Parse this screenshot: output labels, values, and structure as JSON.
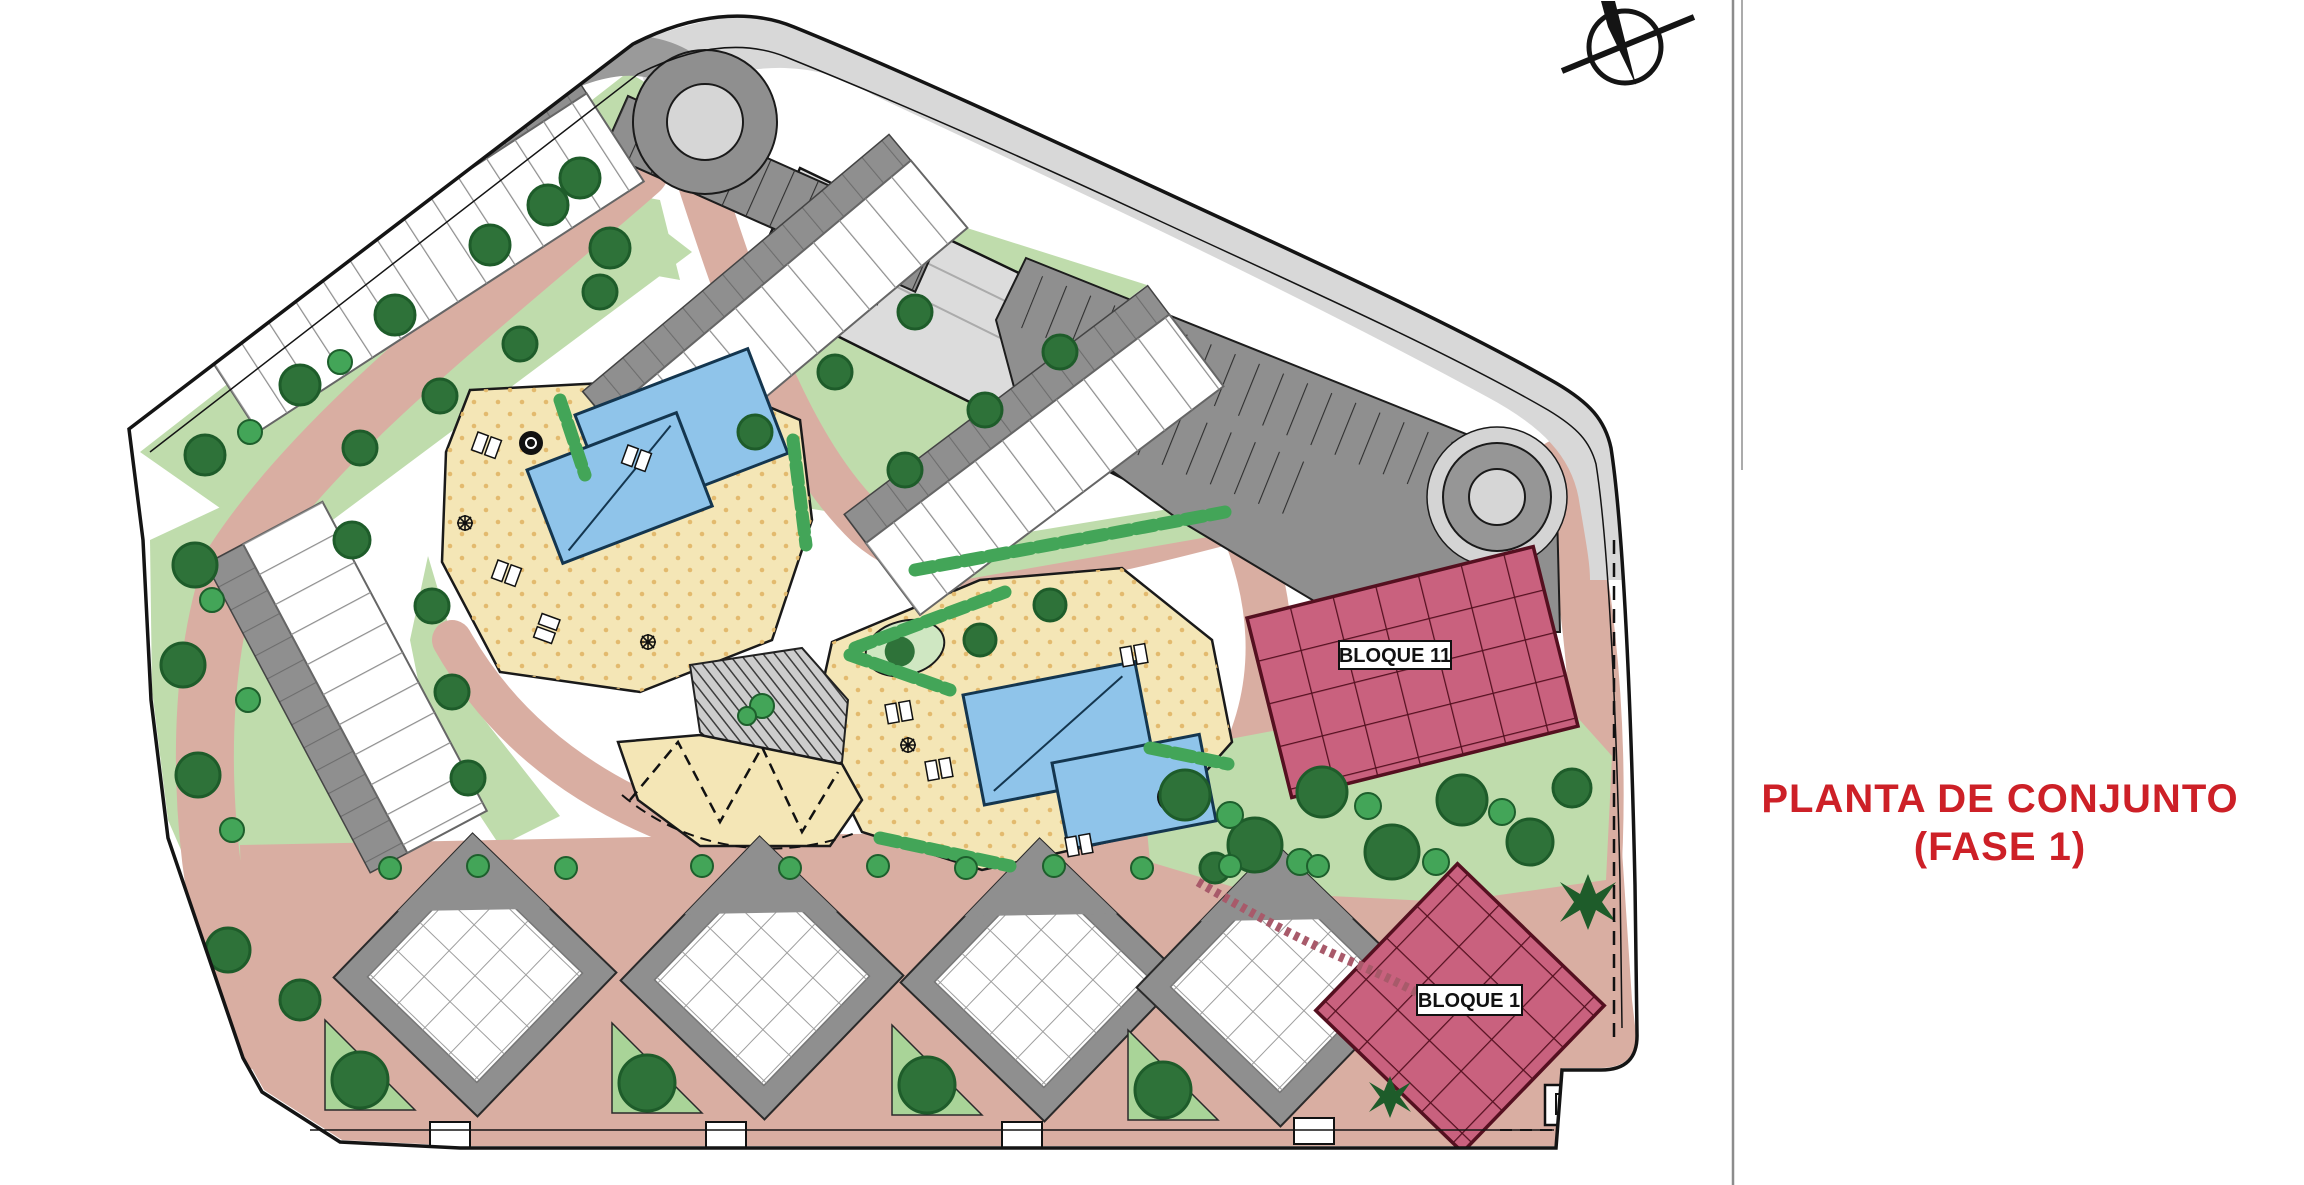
{
  "title_panel": {
    "line1": "PLANTA DE CONJUNTO",
    "line2": "(FASE 1)"
  },
  "plan": {
    "labels": {
      "bloque11": "BLOQUE 11",
      "bloque1": "BLOQUE 1"
    },
    "icons": {
      "north_arrow": "north-arrow-compass"
    }
  },
  "colors": {
    "road": "#d9aea2",
    "deck": "#f4e6b6",
    "deck_dot": "#e3ba6e",
    "pool": "#8fc4ea",
    "lawn": "#bfdcac",
    "lawn_mid": "#a9d498",
    "bush": "#43a558",
    "tree": "#2e7239",
    "tree_dark": "#1e5c2a",
    "parking": "#8f8f8f",
    "road_band": "#d8d8d8",
    "building_zone": "#dcdcdc",
    "roof_gray": "#8f8f8f",
    "white": "#ffffff",
    "outline": "#141414",
    "pink": "#c9617e",
    "pink_line": "#551020",
    "label_bg": "#ffffff",
    "divider": "#9a9a9a",
    "title_red": "#cd2027"
  }
}
